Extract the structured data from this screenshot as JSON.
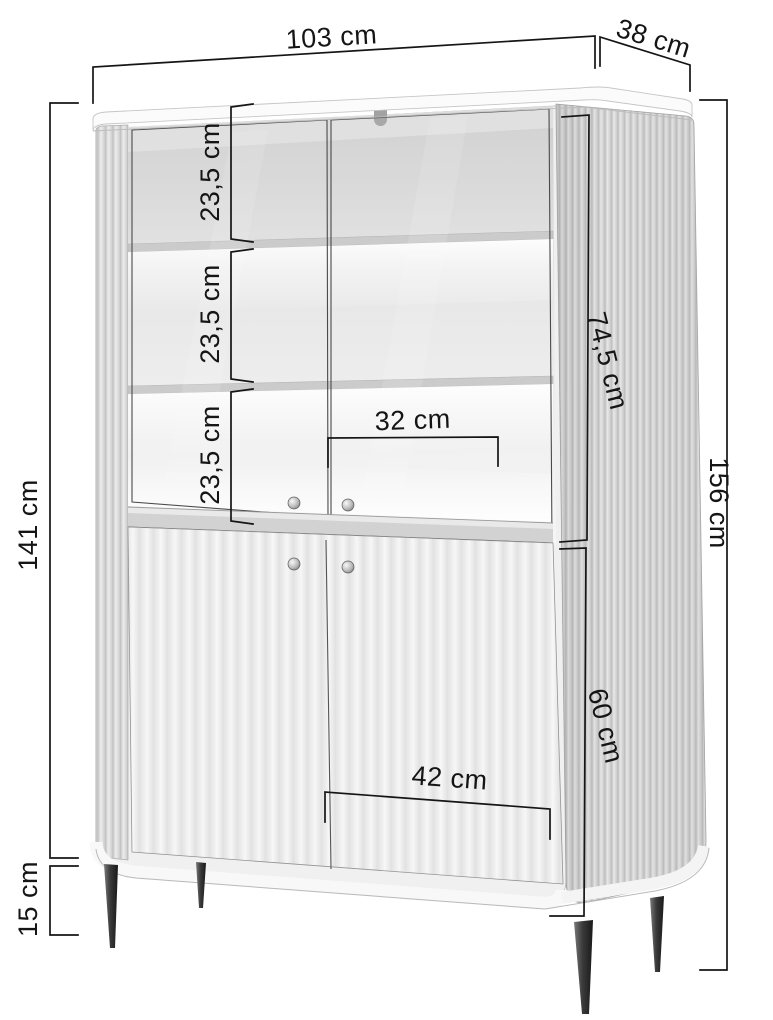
{
  "diagram": {
    "type": "furniture-dimension-diagram",
    "product": "display-cabinet-with-glass-doors",
    "background_color": "#ffffff",
    "line_color": "#151515",
    "leg_color": "#2b2b2b",
    "dimensions": {
      "top_width": "103 cm",
      "top_depth": "38 cm",
      "body_height": "141 cm",
      "leg_height": "15 cm",
      "total_height": "156 cm",
      "upper_section_height": "74,5 cm",
      "lower_section_height": "60 cm",
      "shelf_space_top": "23,5 cm",
      "shelf_space_middle": "23,5 cm",
      "shelf_space_bottom": "23,5 cm",
      "inner_width": "32 cm",
      "bottom_door_width": "42 cm"
    }
  }
}
